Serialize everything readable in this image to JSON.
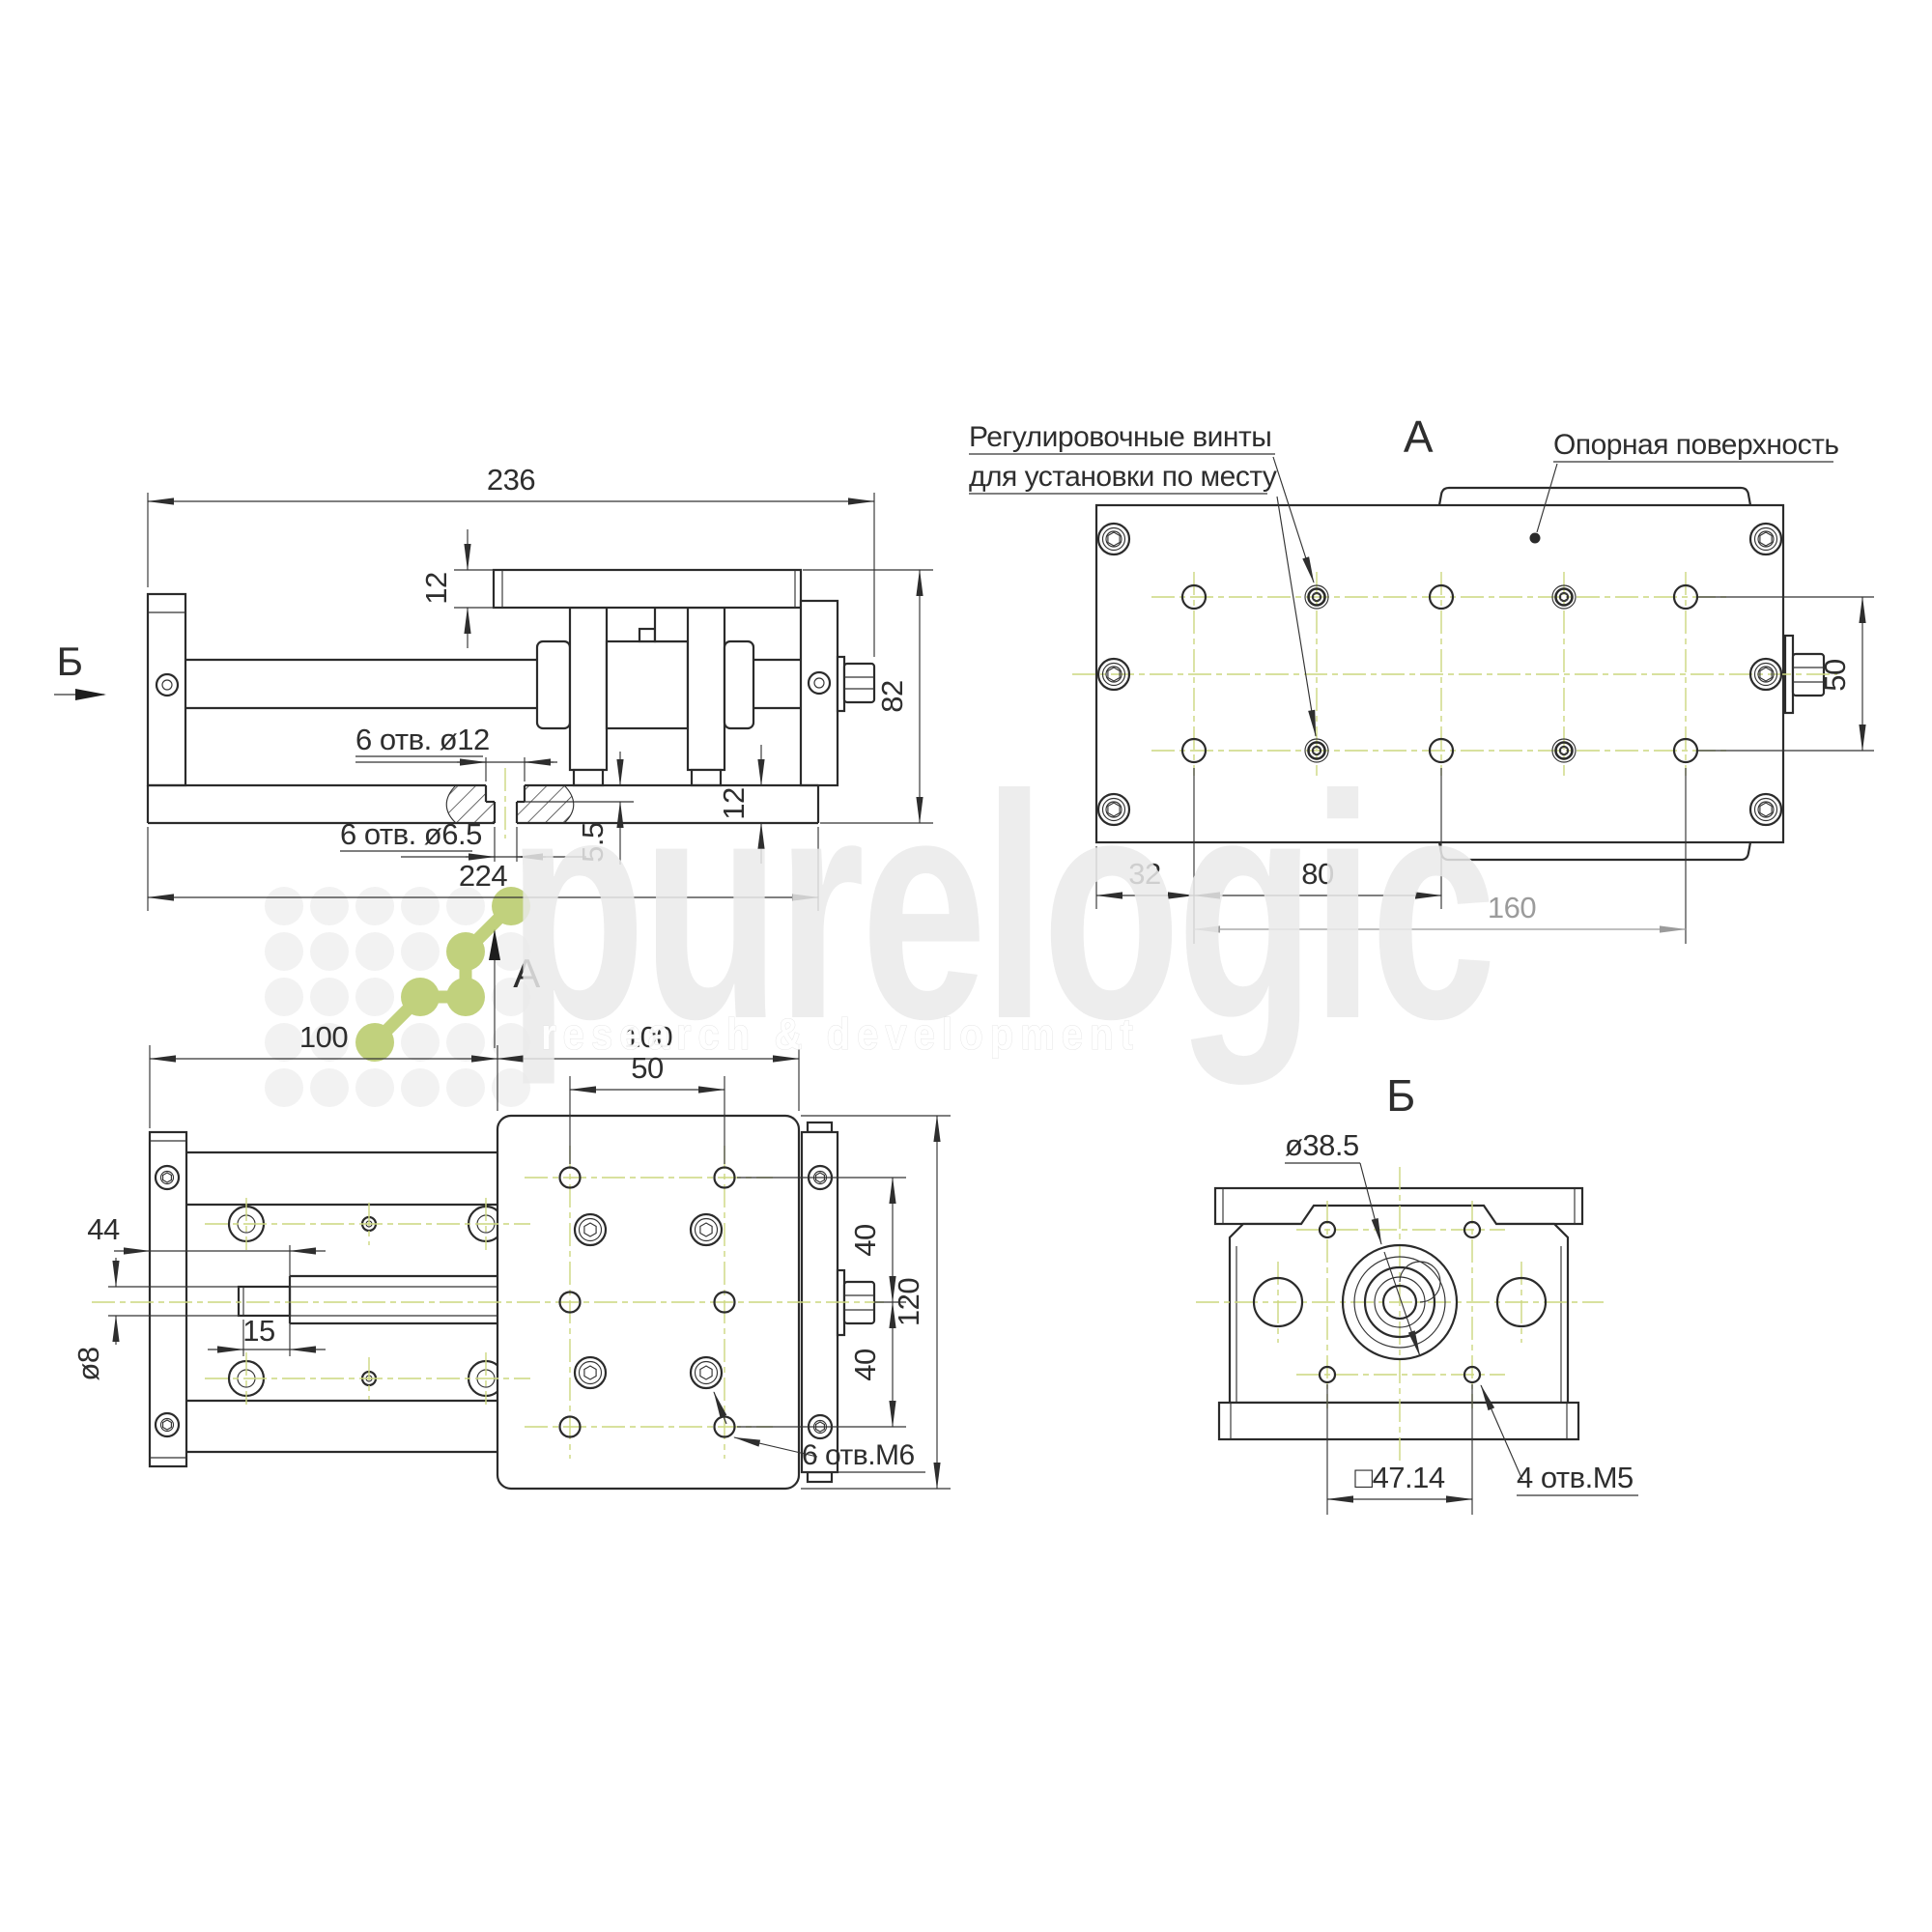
{
  "side": {
    "marker_left": "Б",
    "marker_view": "А",
    "dim_length": "236",
    "dim_plate": "12",
    "dim_height": "82",
    "dim_base": "12",
    "dim_depth": "5.5",
    "dim_holes_span": "224",
    "label_cbore": "6 отв. ø12",
    "label_through": "6 отв. ø6.5"
  },
  "top": {
    "title": "А",
    "note_screws_line1": "Регулировочные винты",
    "note_screws_line2": "для установки по месту",
    "note_surface": "Опорная поверхность",
    "dim_offset": "32",
    "dim_pitch": "80",
    "dim_span": "160",
    "dim_rows": "50"
  },
  "plan": {
    "dim_left": "100",
    "dim_right": "100",
    "dim_holes": "50",
    "dim_stub_pos": "44",
    "dim_stub_len": "15",
    "dim_shaft": "ø8",
    "dim_row_top": "40",
    "dim_row_bot": "40",
    "dim_width": "120",
    "label_holes": "6 отв.М6"
  },
  "end": {
    "title": "Б",
    "label_bore": "ø38.5",
    "dim_square": "□47.14",
    "label_holes": "4 отв.М5"
  },
  "watermark": {
    "brand": "purelogic",
    "tagline": "research & development"
  },
  "colors": {
    "line": "#2b2b2b",
    "centerline": "#ccd77f",
    "logo_green": "#c1d17d",
    "dim_gray": "#9b9b9b",
    "watermark_gray": "#eaeaea"
  }
}
